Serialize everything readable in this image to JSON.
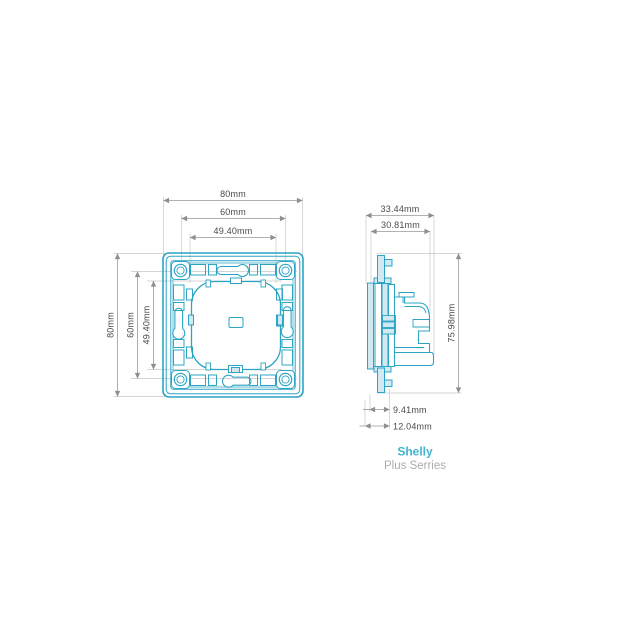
{
  "drawing": {
    "subject": "wall-frame-technical-drawing",
    "front_view": {
      "dims_top": [
        "80mm",
        "60mm",
        "49.40mm"
      ],
      "dims_left": [
        "80mm",
        "60mm",
        "49.40mm"
      ]
    },
    "side_view": {
      "dims_top": [
        "33.44mm",
        "30.81mm"
      ],
      "dim_right": "75.98mm",
      "dims_bottom": [
        "9.41mm",
        "12.04mm"
      ]
    },
    "caption": {
      "brand": "Shelly",
      "series": "Plus Serries"
    },
    "colors": {
      "drawing_line": "#2ba4c5",
      "drawing_fill": "#d2e9f1",
      "dimension_line": "#979797",
      "dimension_text": "#4a4a4a",
      "brand_text": "#3fb5ce",
      "series_text": "#ababab",
      "background": "#ffffff"
    }
  }
}
